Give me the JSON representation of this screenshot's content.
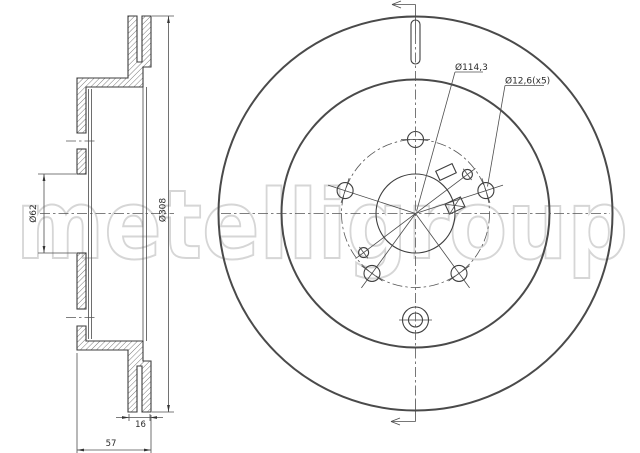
{
  "watermark": {
    "text": "metelligroup"
  },
  "section_view": {
    "label_bore_diameter": "Ø62",
    "label_outer_diameter": "Ø308",
    "label_disc_thickness": "16",
    "label_overall_height": "57"
  },
  "front_view": {
    "label_pitch_circle_diameter": "Ø114,3",
    "label_bolt_hole_diameter": "Ø12,6(x5)"
  },
  "colors": {
    "background": "#ffffff",
    "drawing_line": "#3c3c3c",
    "heavy_line": "#4a4a4a",
    "centerline": "#565656",
    "dimension_text": "#2b2b2b",
    "watermark_outline": "#d6d6d6"
  }
}
